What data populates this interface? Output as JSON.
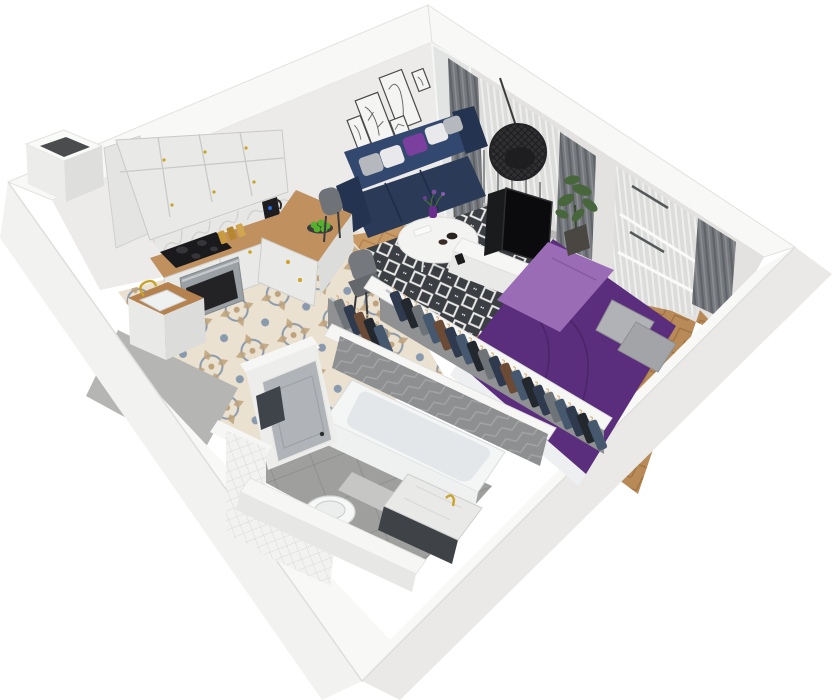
{
  "scene": {
    "type": "isometric-3d-apartment-cutaway-render",
    "rooms": [
      "kitchen",
      "living-room",
      "bedroom",
      "wardrobe",
      "bathroom",
      "hallway",
      "balcony"
    ]
  },
  "inventory": {
    "wall_art_frames": 5,
    "sofa_pillows": 5,
    "counter_chairs": 2,
    "hanging_garments": 24,
    "cooktop_burners": 4,
    "beds": 1,
    "bathtubs": 1,
    "toilets": 1,
    "sinks": 2,
    "hanging_egg_chairs": 1
  },
  "palette": {
    "background": "#ffffff",
    "wall_top": "#f8f8f6",
    "cut_top_white": "#f6f6f4",
    "wall_outer_sw": "#f2f2f0",
    "wall_outer_se": "#eae9e7",
    "wall_inner_nw": "#ecebe9",
    "wall_inner_ne": "#e3e2e0",
    "partition_face": "#e9e9e7",
    "cabinet_white": "#e9eae8",
    "cabinet_tall": "#e4e5e3",
    "cabinet_shade": "#dcdddb",
    "counter_wood": "#c0905f",
    "sink_wood_rim": "#b5824f",
    "backsplash_marble": "#e7e7e5",
    "cooktop_black": "#1a1a1c",
    "oven_steel": "#9aa0a4",
    "oven_window": "#232325",
    "hardware_gold": "#c9a227",
    "floor_tile_base": "#eae1d0",
    "tile_motif_blue": "#8a9aae",
    "tile_motif_tan": "#bfa27c",
    "wood_living": "#c89a66",
    "wood_bedroom": "#b88a58",
    "floor_gray": "#b5b5b3",
    "bath_tile_gray": "#9fa09e",
    "rug_dark": "#3b3e43",
    "rug_light": "#e8e8e6",
    "sofa_navy": "#2a3a57",
    "sofa_navy_light": "#33486e",
    "sofa_navy_dark": "#243450",
    "pillow_white": "#e9e9eb",
    "pillow_gray": "#b5b8bc",
    "pillow_purple": "#7b3f9e",
    "table_white": "#f3f3f1",
    "tv_black": "#0b0b0d",
    "curtain_gray": "#74777b",
    "sheer_light": "#dcdcdb",
    "duvet_purple": "#5a2e7c",
    "blanket_lilac": "#9a6cb5",
    "bed_pillow_gray": "#b0b2b5",
    "bed_pillow_gray2": "#a2a4a7",
    "bed_frame_white": "#edeff1",
    "plant_green": "#47663b",
    "pot_dark": "#4a4743",
    "closet_wall_gray": "#8f9193",
    "clothes_navy": "#2f3a4e",
    "clothes_charcoal": "#23272e",
    "clothes_gray": "#6e7377",
    "clothes_blue": "#45586e",
    "clothes_brown": "#6b4a36",
    "tub_white": "#f4f5f5",
    "tub_inner": "#e4e7e9",
    "chevron_gray": "#8d8f91",
    "small_tile_white": "#f2f2f0",
    "vanity_marble": "#e9e9e7",
    "vanity_base_dark": "#3f4347",
    "toilet_white": "#f6f7f7",
    "door_gray": "#b0b3b7",
    "towel_dark": "#3f444b",
    "egg_chair_black": "#303032",
    "apples_green": "#55b02e"
  }
}
